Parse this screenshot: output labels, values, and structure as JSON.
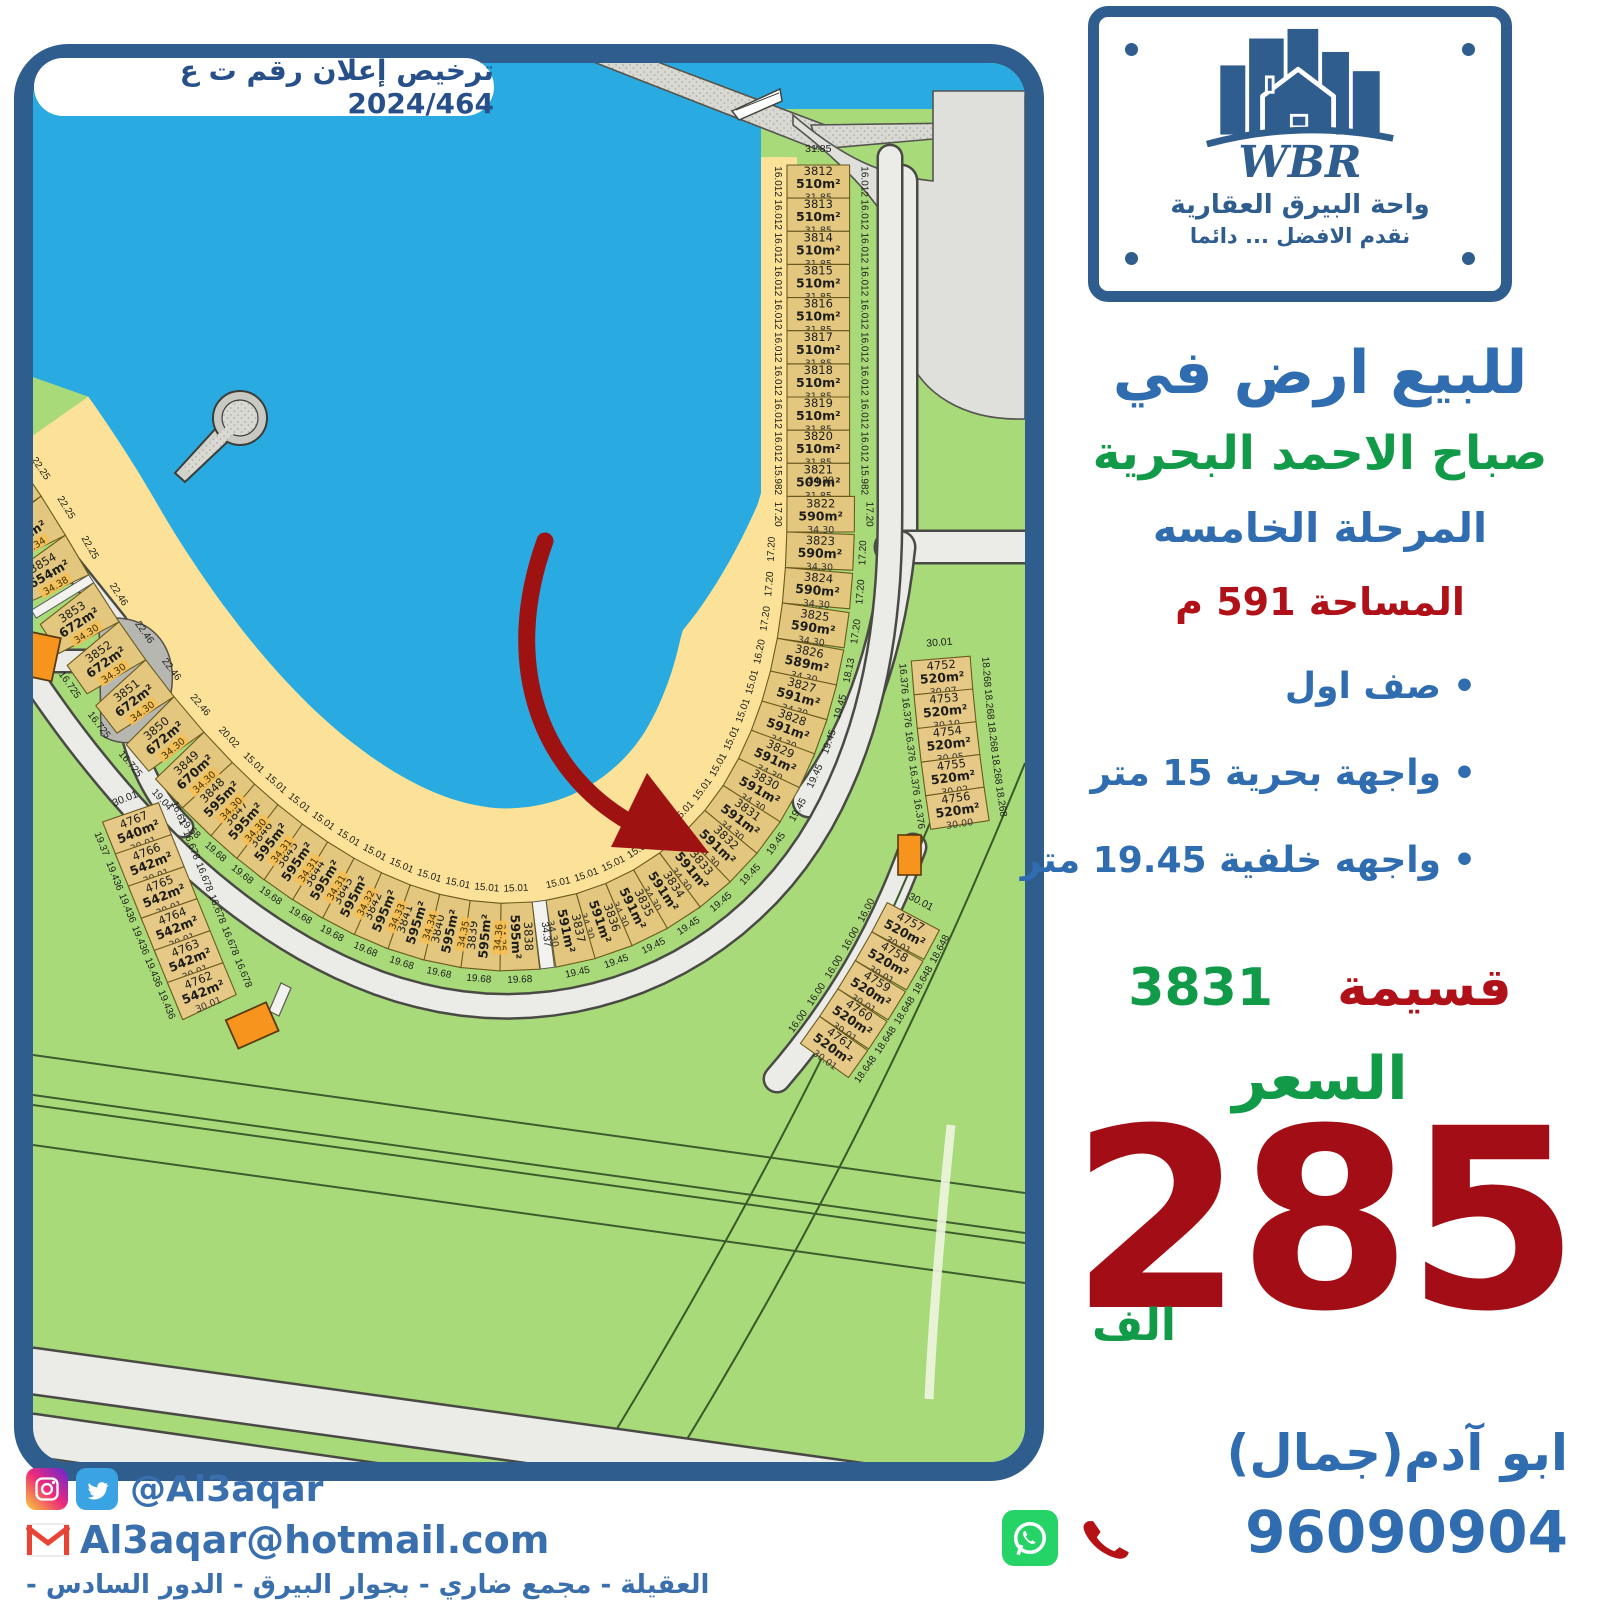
{
  "license": "ترخيص إعلان رقم ت ع 2024/464",
  "logo": {
    "wbr": "WBR",
    "name": "واحة البيرق العقارية",
    "slogan": "نقدم الافضل ... دائما"
  },
  "headline": {
    "sale": "للبيع ارض في",
    "location": "صباح الاحمد البحرية",
    "phase": "المرحلة الخامسه",
    "area": "المساحة 591 م"
  },
  "features": [
    "صف اول",
    "واجهة بحرية 15 متر",
    "واجهه خلفية 19.45 متر"
  ],
  "parcel": {
    "label": "قسيمة",
    "number": "3831"
  },
  "price": {
    "label": "السعر",
    "value": "285",
    "unit": "الف"
  },
  "agent": {
    "name": "ابو آدم(جمال)",
    "phone": "96090904"
  },
  "footer": {
    "social_handle": "@Al3aqar",
    "email": "Al3aqar@hotmail.com",
    "address": "العقيلة - مجمع ضاري - بجوار البيرق - الدور السادس - مكتب 6"
  },
  "colors": {
    "frame": "#2e5d8e",
    "water": "#29abe2",
    "sand": "#fbe298",
    "land": "#a8da7a",
    "plot": "#e3c77e",
    "road": "#ebebe8",
    "orange": "#f7941d",
    "blue_text": "#2f6db0",
    "green_text": "#119a48",
    "red_text": "#b01119",
    "price_red": "#a30d15",
    "arrow": "#9e1212"
  },
  "map": {
    "walkway_label": "34.37",
    "ring_plots": [
      {
        "n": "3812",
        "a": "510m²",
        "d": "31.85",
        "f": "16.012",
        "o": "16.012",
        "w": 16.012,
        "dep": 31.85,
        "top": "31.85"
      },
      {
        "n": "3813",
        "a": "510m²",
        "d": "31.85",
        "f": "16.012",
        "o": "16.012",
        "w": 16.012,
        "dep": 31.85
      },
      {
        "n": "3814",
        "a": "510m²",
        "d": "31.85",
        "f": "16.012",
        "o": "16.012",
        "w": 16.012,
        "dep": 31.85
      },
      {
        "n": "3815",
        "a": "510m²",
        "d": "31.85",
        "f": "16.012",
        "o": "16.012",
        "w": 16.012,
        "dep": 31.85
      },
      {
        "n": "3816",
        "a": "510m²",
        "d": "31.85",
        "f": "16.012",
        "o": "16.012",
        "w": 16.012,
        "dep": 31.85
      },
      {
        "n": "3817",
        "a": "510m²",
        "d": "31.85",
        "f": "16.012",
        "o": "16.012",
        "w": 16.012,
        "dep": 31.85
      },
      {
        "n": "3818",
        "a": "510m²",
        "d": "31.85",
        "f": "16.012",
        "o": "16.012",
        "w": 16.012,
        "dep": 31.85
      },
      {
        "n": "3819",
        "a": "510m²",
        "d": "31.85",
        "f": "16.012",
        "o": "16.012",
        "w": 16.012,
        "dep": 31.85
      },
      {
        "n": "3820",
        "a": "510m²",
        "d": "31.85",
        "f": "16.012",
        "o": "16.012",
        "w": 16.012,
        "dep": 31.85
      },
      {
        "n": "3821",
        "a": "509m²",
        "d": "31.85",
        "f": "15.982",
        "o": "15.982",
        "w": 15.982,
        "dep": 31.85
      },
      {
        "n": "3822",
        "a": "590m²",
        "d": "34.30",
        "f": "17.20",
        "o": "17.20",
        "w": 17.2,
        "top": "34.30"
      },
      {
        "n": "3823",
        "a": "590m²",
        "d": "34.30",
        "f": "17.20",
        "o": "17.20",
        "w": 17.2
      },
      {
        "n": "3824",
        "a": "590m²",
        "d": "34.30",
        "f": "17.20",
        "o": "17.20",
        "w": 17.2
      },
      {
        "n": "3825",
        "a": "590m²",
        "d": "34.30",
        "f": "17.20",
        "o": "17.20",
        "w": 17.2
      },
      {
        "n": "3826",
        "a": "589m²",
        "d": "34.30",
        "f": "16.20",
        "o": "18.13",
        "w": 16.2,
        "bw": 18.13
      },
      {
        "n": "3827",
        "a": "591m²",
        "d": "34.30",
        "f": "15.01",
        "o": "19.45",
        "w": 15.01,
        "bw": 19.45
      },
      {
        "n": "3828",
        "a": "591m²",
        "d": "34.30",
        "f": "15.01",
        "o": "19.45",
        "w": 15.01,
        "bw": 19.45
      },
      {
        "n": "3829",
        "a": "591m²",
        "d": "34.30",
        "f": "15.01",
        "o": "19.45",
        "w": 15.01,
        "bw": 19.45
      },
      {
        "n": "3830",
        "a": "591m²",
        "d": "34.30",
        "f": "15.01",
        "o": "19.45",
        "w": 15.01,
        "bw": 19.45
      },
      {
        "n": "3831",
        "a": "591m²",
        "d": "34.30",
        "f": "15.01",
        "o": "19.45",
        "w": 15.01,
        "bw": 19.45
      },
      {
        "n": "3832",
        "a": "591m²",
        "d": "34.30",
        "f": "15.01",
        "o": "19.45",
        "w": 15.01,
        "bw": 19.45
      },
      {
        "n": "3833",
        "a": "591m²",
        "d": "34.30",
        "f": "15.01",
        "o": "19.45",
        "w": 15.01,
        "bw": 19.45
      },
      {
        "n": "3834",
        "a": "591m²",
        "d": "34.30",
        "f": "15.01",
        "o": "19.45",
        "w": 15.01,
        "bw": 19.45
      },
      {
        "n": "3835",
        "a": "591m²",
        "d": "34.30",
        "f": "15.01",
        "o": "19.45",
        "w": 15.01,
        "bw": 19.45
      },
      {
        "n": "3836",
        "a": "591m²",
        "d": "34.30",
        "f": "15.01",
        "o": "19.45",
        "w": 15.01,
        "bw": 19.45
      },
      {
        "n": "3837",
        "a": "591m²",
        "d": "34.30",
        "f": "15.01",
        "o": "19.45",
        "w": 15.01,
        "bw": 19.45
      },
      {
        "gap": true,
        "w": 6.8,
        "d": "34.37"
      },
      {
        "n": "3838",
        "a": "595m²",
        "d": "34.36",
        "f": "15.01",
        "o": "19.68",
        "w": 15.01,
        "bw": 19.68,
        "hl": true
      },
      {
        "n": "3839",
        "a": "595m²",
        "d": "34.36",
        "f": "15.01",
        "o": "19.68",
        "w": 15.01,
        "bw": 19.68,
        "hl": true
      },
      {
        "n": "3840",
        "a": "595m²",
        "d": "34.35",
        "f": "15.01",
        "o": "19.68",
        "w": 15.01,
        "bw": 19.68,
        "hl": true
      },
      {
        "n": "3841",
        "a": "595m²",
        "d": "34.34",
        "f": "15.01",
        "o": "19.68",
        "w": 15.01,
        "bw": 19.68,
        "hl": true
      },
      {
        "n": "3842",
        "a": "595m²",
        "d": "34.33",
        "f": "15.01",
        "o": "19.68",
        "w": 15.01,
        "bw": 19.68,
        "hl": true
      },
      {
        "n": "3843",
        "a": "595m²",
        "d": "34.32",
        "f": "15.01",
        "o": "19.68",
        "w": 15.01,
        "bw": 19.68,
        "hl": true
      },
      {
        "n": "3844",
        "a": "595m²",
        "d": "34.31",
        "f": "15.01",
        "o": "19.68",
        "w": 15.01,
        "bw": 19.68,
        "hl": true
      },
      {
        "n": "3845",
        "a": "595m²",
        "d": "34.31",
        "f": "15.01",
        "o": "19.68",
        "w": 15.01,
        "bw": 19.68,
        "hl": true
      },
      {
        "n": "3846",
        "a": "595m²",
        "d": "34.31",
        "f": "15.01",
        "o": "19.68",
        "w": 15.01,
        "bw": 19.68,
        "hl": true
      },
      {
        "n": "3847",
        "a": "595m²",
        "d": "34.30",
        "f": "15.01",
        "o": "19.68",
        "w": 15.01,
        "bw": 19.68,
        "hl": true
      },
      {
        "n": "3848",
        "a": "595m²",
        "d": "34.30",
        "f": "15.01",
        "o": "19.68",
        "w": 15.01,
        "bw": 19.68,
        "hl": true
      },
      {
        "n": "3849",
        "a": "670m²",
        "d": "34.30",
        "f": "20.02",
        "o": "19.04",
        "w": 20.02,
        "bw": 19.04,
        "hl": true
      },
      {
        "n": "3850",
        "a": "672m²",
        "d": "34.30",
        "f": "22.46",
        "o": "16.725",
        "w": 22.46,
        "bw": 16.725,
        "hl": true
      },
      {
        "n": "3851",
        "a": "672m²",
        "d": "34.30",
        "f": "22.46",
        "o": "16.725",
        "w": 22.46,
        "bw": 16.725,
        "hl": true
      },
      {
        "n": "3852",
        "a": "672m²",
        "d": "34.30",
        "f": "22.46",
        "o": "16.725",
        "w": 22.46,
        "bw": 16.725,
        "hl": true
      },
      {
        "n": "3853",
        "a": "672m²",
        "d": "34.30",
        "f": "22.46",
        "o": "",
        "w": 22.46,
        "bw": 16.725,
        "hl": true
      },
      {
        "gap": true,
        "w": 4.5
      },
      {
        "n": "3854",
        "a": "654m²",
        "d": "34.38",
        "f": "22.25",
        "o": "15.88",
        "w": 22.25,
        "bw": 15.88,
        "dep": 34.34,
        "hl": true
      },
      {
        "n": "3855",
        "a": "654m²",
        "d": "34.34",
        "f": "22.25",
        "o": "15.88",
        "w": 22.25,
        "bw": 15.88,
        "dep": 34.34,
        "hl": true
      },
      {
        "n": "",
        "a": "",
        "d": "34.31",
        "f": "22.25",
        "o": "",
        "w": 22.25,
        "dep": 34.34,
        "hl": true
      }
    ],
    "col_right_upper": {
      "top": "30.01",
      "plots": [
        {
          "n": "4752",
          "a": "520m²",
          "d": "30.07",
          "f": "16.376",
          "o": "18.268",
          "w": 16.376,
          "dep": 30.01,
          "top": "30.01"
        },
        {
          "n": "4753",
          "a": "520m²",
          "d": "30.10",
          "f": "16.376",
          "o": "18.268",
          "w": 16.376,
          "dep": 30.01
        },
        {
          "n": "4754",
          "a": "520m²",
          "d": "30.05",
          "f": "16.376",
          "o": "18.268",
          "w": 16.376,
          "dep": 30.01
        },
        {
          "n": "4755",
          "a": "520m²",
          "d": "30.02",
          "f": "16.376",
          "o": "18.268",
          "w": 16.376,
          "dep": 30.01
        },
        {
          "n": "4756",
          "a": "520m²",
          "d": "30.00",
          "f": "16.376",
          "o": "18.268",
          "w": 16.376,
          "dep": 30.01
        }
      ]
    },
    "col_right_lower": {
      "top": "30.01",
      "plots": [
        {
          "n": "4757",
          "a": "520m²",
          "d": "30.01",
          "f": "16.00",
          "o": "18.648",
          "w": 16.0,
          "dep": 30.01,
          "top": "30.01"
        },
        {
          "n": "4758",
          "a": "520m²",
          "d": "30.01",
          "f": "16.00",
          "o": "18.648",
          "w": 16.0,
          "dep": 30.01
        },
        {
          "n": "4759",
          "a": "520m²",
          "d": "30.01",
          "f": "16.00",
          "o": "18.648",
          "w": 16.0,
          "dep": 30.01
        },
        {
          "n": "4760",
          "a": "520m²",
          "d": "30.01",
          "f": "16.00",
          "o": "18.648",
          "w": 16.0,
          "dep": 30.01
        },
        {
          "n": "4761",
          "a": "520m²",
          "d": "30.01",
          "f": "16.00",
          "o": "18.648",
          "w": 16.0,
          "dep": 30.01
        }
      ]
    },
    "col_left": {
      "top": "30.01",
      "plots": [
        {
          "n": "4767",
          "a": "540m²",
          "d": "30.01",
          "f": "16.61",
          "o": "19.37",
          "w": 16.61,
          "bw": 19.37,
          "dep": 30.01,
          "top": "30.01"
        },
        {
          "n": "4766",
          "a": "542m²",
          "d": "30.01",
          "f": "16.678",
          "o": "19.436",
          "w": 16.678,
          "bw": 19.436,
          "dep": 30.01
        },
        {
          "n": "4765",
          "a": "542m²",
          "d": "30.01",
          "f": "16.678",
          "o": "19.436",
          "w": 16.678,
          "bw": 19.436,
          "dep": 30.01
        },
        {
          "n": "4764",
          "a": "542m²",
          "d": "30.01",
          "f": "16.678",
          "o": "19.436",
          "w": 16.678,
          "bw": 19.436,
          "dep": 30.01
        },
        {
          "n": "4763",
          "a": "542m²",
          "d": "30.01",
          "f": "16.678",
          "o": "19.436",
          "w": 16.678,
          "bw": 19.436,
          "dep": 30.01
        },
        {
          "n": "4762",
          "a": "542m²",
          "d": "30.01",
          "f": "16.678",
          "o": "19.436",
          "w": 16.678,
          "bw": 19.436,
          "dep": 30.01
        }
      ]
    }
  }
}
